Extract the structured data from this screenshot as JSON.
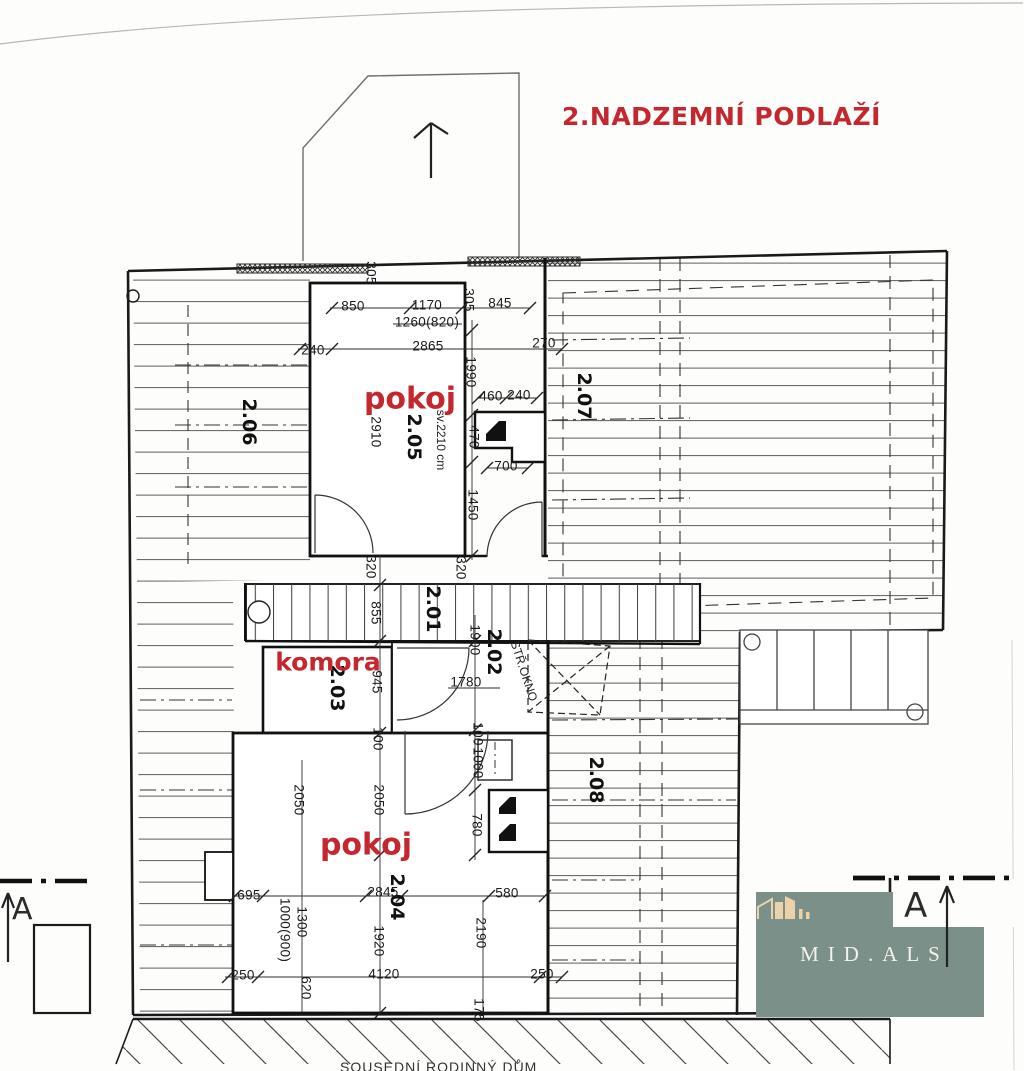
{
  "title": {
    "text": "2.NADZEMNÍ PODLAŽÍ"
  },
  "colors": {
    "accent_red": "#c4272e",
    "logo_bg": "#7b9089",
    "logo_icon": "#ecd2a9",
    "logo_text": "#f4f1ea",
    "line": "#2a2a2a"
  },
  "logo": {
    "brand": "MID.ALS",
    "icon": "house-icon"
  },
  "section_markers": {
    "left_label": "A",
    "right_label": "A"
  },
  "footer": {
    "neighbor_label": "SOUSEDNÍ RODINNÝ DŮM"
  },
  "plan": {
    "labels": [
      {
        "text": "305",
        "x": 371,
        "y": 273,
        "rot": 90,
        "kind": "dim"
      },
      {
        "text": "305",
        "x": 469,
        "y": 300,
        "rot": 90,
        "kind": "dim"
      },
      {
        "text": "850",
        "x": 353,
        "y": 306,
        "rot": 0,
        "kind": "dim"
      },
      {
        "text": "1170",
        "x": 427,
        "y": 305,
        "rot": 0,
        "kind": "dim"
      },
      {
        "text": "1260(820)",
        "x": 427,
        "y": 322,
        "rot": 0,
        "kind": "dim"
      },
      {
        "text": "845",
        "x": 500,
        "y": 303,
        "rot": 0,
        "kind": "dim"
      },
      {
        "text": "240",
        "x": 313,
        "y": 350,
        "rot": 0,
        "kind": "dim"
      },
      {
        "text": "2865",
        "x": 428,
        "y": 346,
        "rot": 0,
        "kind": "dim"
      },
      {
        "text": "270",
        "x": 544,
        "y": 343,
        "rot": 0,
        "kind": "dim"
      },
      {
        "text": "1990",
        "x": 471,
        "y": 372,
        "rot": 90,
        "kind": "dim"
      },
      {
        "text": "460",
        "x": 491,
        "y": 396,
        "rot": 0,
        "kind": "dim"
      },
      {
        "text": "240",
        "x": 519,
        "y": 395,
        "rot": 0,
        "kind": "dim"
      },
      {
        "text": "2910",
        "x": 376,
        "y": 432,
        "rot": 90,
        "kind": "dim"
      },
      {
        "text": "470",
        "x": 474,
        "y": 437,
        "rot": 90,
        "kind": "dim"
      },
      {
        "text": "700",
        "x": 506,
        "y": 466,
        "rot": 0,
        "kind": "dim"
      },
      {
        "text": "1450",
        "x": 473,
        "y": 505,
        "rot": 90,
        "kind": "dim"
      },
      {
        "text": "320",
        "x": 371,
        "y": 567,
        "rot": 90,
        "kind": "dim"
      },
      {
        "text": "320",
        "x": 461,
        "y": 568,
        "rot": 90,
        "kind": "dim"
      },
      {
        "text": "855",
        "x": 376,
        "y": 613,
        "rot": 90,
        "kind": "dim"
      },
      {
        "text": "1900",
        "x": 475,
        "y": 640,
        "rot": 90,
        "kind": "dim"
      },
      {
        "text": "945",
        "x": 377,
        "y": 682,
        "rot": 90,
        "kind": "dim"
      },
      {
        "text": "1780",
        "x": 466,
        "y": 682,
        "rot": 0,
        "kind": "dim"
      },
      {
        "text": "100",
        "x": 378,
        "y": 739,
        "rot": 90,
        "kind": "dim"
      },
      {
        "text": "100",
        "x": 478,
        "y": 734,
        "rot": 90,
        "kind": "dim"
      },
      {
        "text": "1000",
        "x": 478,
        "y": 763,
        "rot": 90,
        "kind": "dim"
      },
      {
        "text": "2050",
        "x": 299,
        "y": 800,
        "rot": 90,
        "kind": "dim"
      },
      {
        "text": "2050",
        "x": 379,
        "y": 800,
        "rot": 90,
        "kind": "dim"
      },
      {
        "text": "780",
        "x": 477,
        "y": 825,
        "rot": 90,
        "kind": "dim"
      },
      {
        "text": "695",
        "x": 249,
        "y": 895,
        "rot": 0,
        "kind": "dim"
      },
      {
        "text": "2845",
        "x": 383,
        "y": 892,
        "rot": 0,
        "kind": "dim"
      },
      {
        "text": "580",
        "x": 507,
        "y": 893,
        "rot": 0,
        "kind": "dim"
      },
      {
        "text": "1300",
        "x": 302,
        "y": 922,
        "rot": 90,
        "kind": "dim"
      },
      {
        "text": "1000(900)",
        "x": 285,
        "y": 930,
        "rot": 90,
        "kind": "dim"
      },
      {
        "text": "1920",
        "x": 379,
        "y": 941,
        "rot": 90,
        "kind": "dim"
      },
      {
        "text": "2190",
        "x": 481,
        "y": 933,
        "rot": 90,
        "kind": "dim"
      },
      {
        "text": "250",
        "x": 243,
        "y": 975,
        "rot": 0,
        "kind": "dim"
      },
      {
        "text": "620",
        "x": 306,
        "y": 988,
        "rot": 90,
        "kind": "dim"
      },
      {
        "text": "4120",
        "x": 384,
        "y": 974,
        "rot": 0,
        "kind": "dim"
      },
      {
        "text": "250",
        "x": 542,
        "y": 974,
        "rot": 0,
        "kind": "dim"
      },
      {
        "text": "175",
        "x": 479,
        "y": 1010,
        "rot": 90,
        "kind": "dim"
      },
      {
        "text": "2.06",
        "x": 249,
        "y": 422,
        "rot": 90,
        "kind": "room-num"
      },
      {
        "text": "2.05",
        "x": 414,
        "y": 437,
        "rot": 90,
        "kind": "room-num"
      },
      {
        "text": "2.07",
        "x": 584,
        "y": 396,
        "rot": 90,
        "kind": "room-num"
      },
      {
        "text": "2.01",
        "x": 433,
        "y": 609,
        "rot": 90,
        "kind": "room-num"
      },
      {
        "text": "2.02",
        "x": 494,
        "y": 652,
        "rot": 90,
        "kind": "room-num"
      },
      {
        "text": "2.03",
        "x": 337,
        "y": 688,
        "rot": 90,
        "kind": "room-num"
      },
      {
        "text": "2.04",
        "x": 397,
        "y": 897,
        "rot": 90,
        "kind": "room-num"
      },
      {
        "text": "2.08",
        "x": 596,
        "y": 780,
        "rot": 90,
        "kind": "room-num"
      },
      {
        "text": "pokoj",
        "x": 410,
        "y": 399,
        "rot": 0,
        "kind": "room-name-lg"
      },
      {
        "text": "pokoj",
        "x": 366,
        "y": 845,
        "rot": 0,
        "kind": "room-name-lg"
      },
      {
        "text": "komora",
        "x": 328,
        "y": 662,
        "rot": 0,
        "kind": "room-name-md"
      },
      {
        "text": "sv.2210 cm",
        "x": 441,
        "y": 440,
        "rot": 90,
        "kind": "note"
      },
      {
        "text": "STŘ.OKNO",
        "x": 524,
        "y": 671,
        "rot": 72,
        "kind": "note"
      }
    ]
  }
}
